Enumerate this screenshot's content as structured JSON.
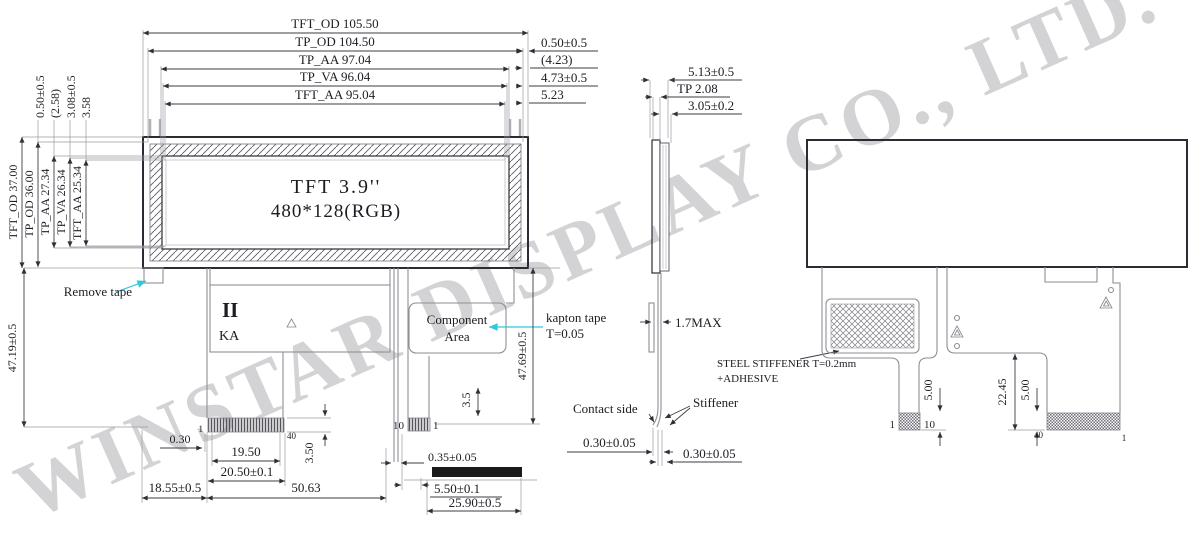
{
  "watermark": "WINSTAR DISPLAY CO., LTD.",
  "front": {
    "display_line1": "TFT  3.9''",
    "display_line2": "480*128(RGB)",
    "top_dims": [
      "TFT_OD 105.50",
      "TP_OD 104.50",
      "TP_AA 97.04",
      "TP_VA 96.04",
      "TFT_AA 95.04"
    ],
    "top_right_dims": [
      "0.50±0.5",
      "(4.23)",
      "4.73±0.5",
      "5.23"
    ],
    "left_dims": [
      "TFT_OD 37.00",
      "TP_OD 36.00",
      "TP_AA 27.34",
      "TP_VA 26.34",
      "TFT_AA 25.34"
    ],
    "left_top_dims": [
      "0.50±0.5",
      "(2.58)",
      "3.08±0.5",
      "3.58"
    ],
    "remove_tape": "Remove tape",
    "height_left": "47.19±0.5",
    "ka_mark": "II",
    "ka_label": "KA",
    "component_area": [
      "Component",
      "Area"
    ],
    "kapton_note": [
      "kapton tape",
      "T=0.05"
    ],
    "height_right": "47.69±0.5",
    "gap_35": "3.5",
    "dim_030": "0.30",
    "pin_1_left": "1",
    "pin_40": "40",
    "dim_1950": "19.50",
    "dim_2050": "20.50±0.1",
    "dim_1855": "18.55±0.5",
    "dim_5063": "50.63",
    "dim_350": "3.50",
    "pin_10": "10",
    "pin_1_right": "1",
    "dim_035": "0.35±0.05",
    "dim_550": "5.50±0.1",
    "dim_2590": "25.90±0.5"
  },
  "side": {
    "dim_513": "5.13±0.5",
    "dim_tp": "TP 2.08",
    "dim_305": "3.05±0.2",
    "dim_17max": "1.7MAX",
    "stiffener_note": [
      "STEEL STIFFENER  T=0.2mm",
      "+ADHESIVE"
    ],
    "stiffener": "Stiffener",
    "contact_side": "Contact side",
    "dim_030_left": "0.30±0.05",
    "dim_030_right": "0.30±0.05"
  },
  "back": {
    "dim_500_left": "5.00",
    "pin_1_left": "1",
    "pin_10": "10",
    "dim_2245": "22.45",
    "dim_500_right": "5.00",
    "pin_40": "40",
    "pin_1_right": "1"
  },
  "colors": {
    "cyan_accent": "#2fc9dd",
    "line_dark": "#2b2b33",
    "line_gray": "#8e8e96",
    "watermark_gray": "#d3d3d6",
    "stiffener_black": "#1b1b1b"
  }
}
